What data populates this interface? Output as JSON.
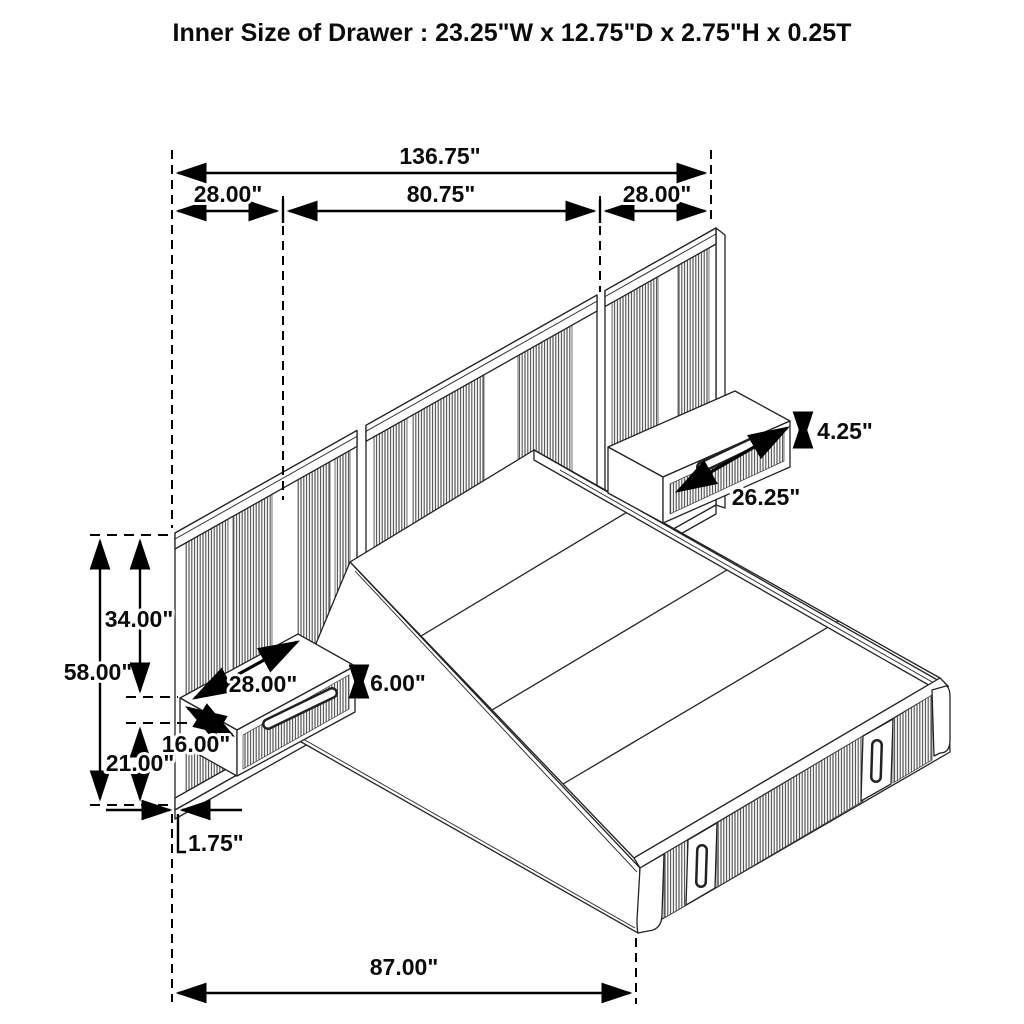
{
  "title": "Inner Size of Drawer : 23.25\"W x 12.75\"D x 2.75\"H x 0.25T",
  "colors": {
    "ink": "#0b0b0b",
    "line_art": "#222222",
    "reed_fill": "#4a4a4a",
    "background": "#ffffff"
  },
  "dimensions": {
    "total_width": "136.75\"",
    "left_panel_width": "28.00\"",
    "headboard_width": "80.75\"",
    "right_panel_width": "28.00\"",
    "panel_height": "58.00\"",
    "panel_top_to_shelf": "34.00\"",
    "floor_to_shelf": "21.00\"",
    "nightstand_width": "28.00\"",
    "nightstand_depth": "16.00\"",
    "nightstand_height": "6.00\"",
    "drawer_face_height": "4.25\"",
    "drawer_face_width": "26.25\"",
    "panel_thickness": "1.75\"",
    "bed_length": "87.00\""
  }
}
